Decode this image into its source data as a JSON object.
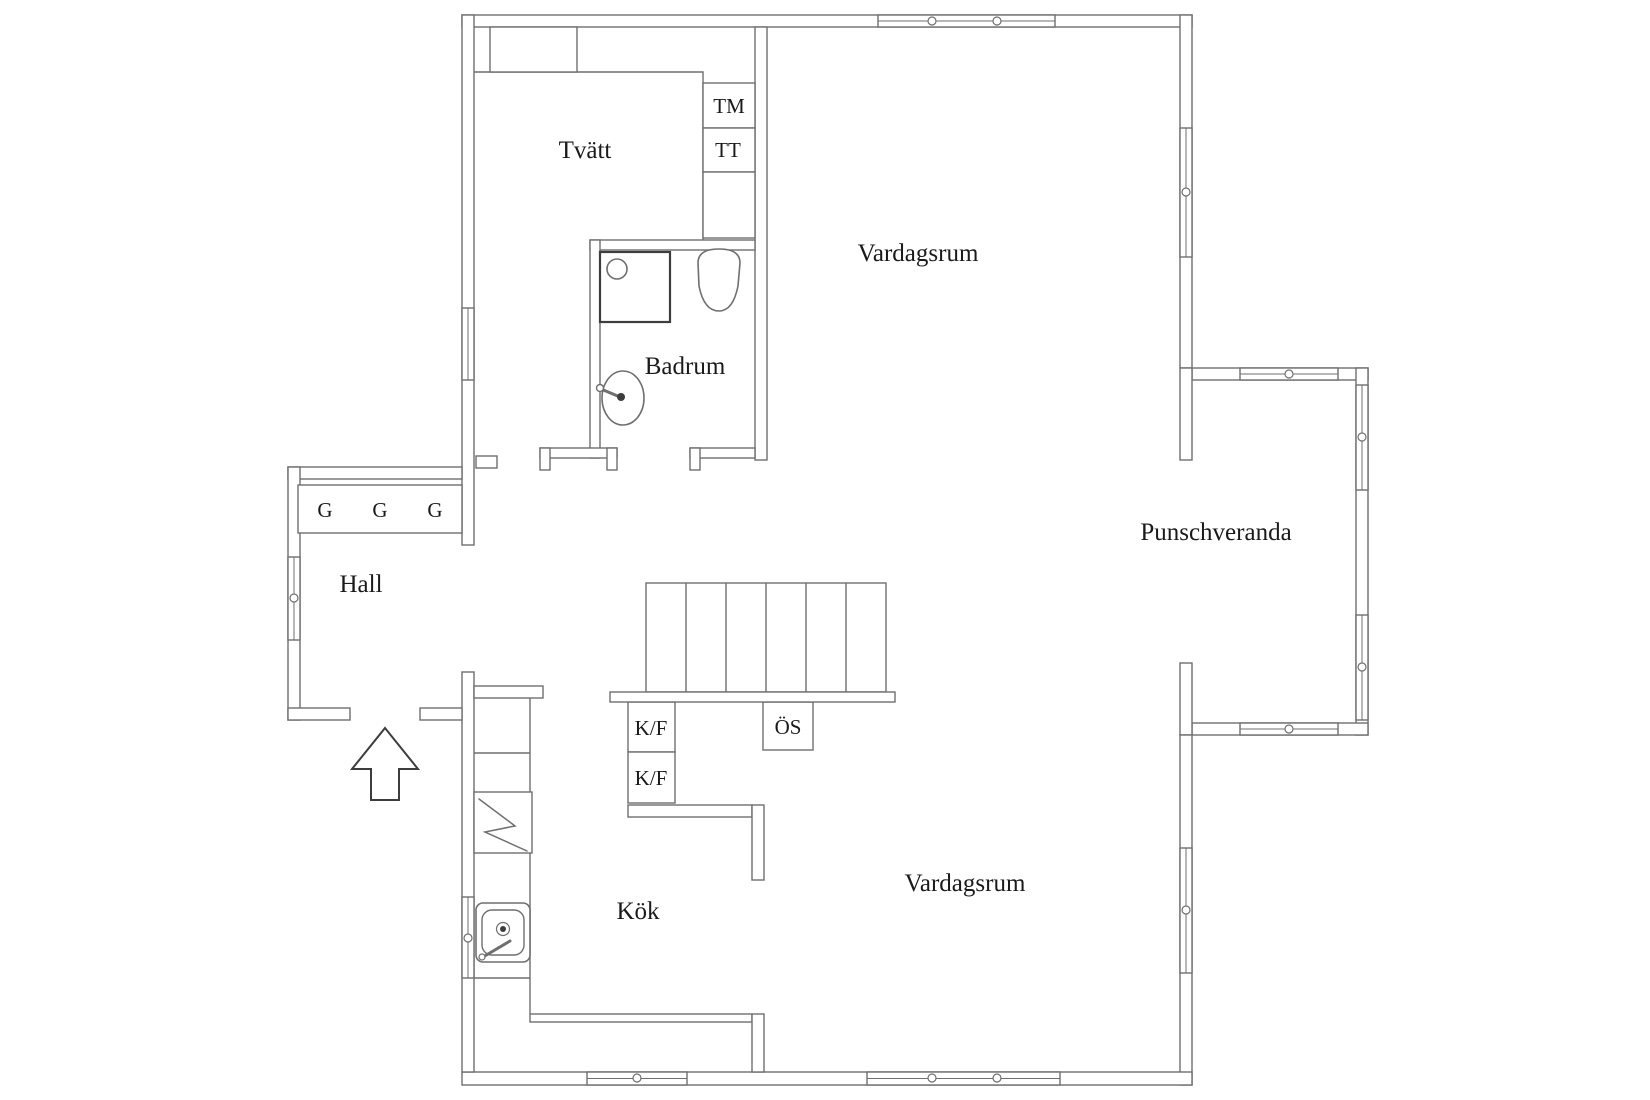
{
  "page": {
    "title": "Floor plan",
    "background": "#ffffff"
  },
  "palette": {
    "wall_line": "#6f6f6f",
    "dark_line": "#3d3d3d",
    "text_color": "#1a1a1a",
    "white": "#ffffff"
  },
  "plan": {
    "canvas": {
      "width": 1650,
      "height": 1100
    },
    "rooms": [
      {
        "id": "tvatt",
        "label": "Tvätt",
        "x": 585,
        "y": 158
      },
      {
        "id": "badrum",
        "label": "Badrum",
        "x": 685,
        "y": 374
      },
      {
        "id": "vardagsrum-upper",
        "label": "Vardagsrum",
        "x": 918,
        "y": 261
      },
      {
        "id": "hall",
        "label": "Hall",
        "x": 361,
        "y": 592
      },
      {
        "id": "kok",
        "label": "Kök",
        "x": 638,
        "y": 919
      },
      {
        "id": "vardagsrum-lower",
        "label": "Vardagsrum",
        "x": 965,
        "y": 891
      },
      {
        "id": "punschveranda",
        "label": "Punschveranda",
        "x": 1216,
        "y": 540
      }
    ],
    "small_labels": [
      {
        "id": "closet-1",
        "label": "G",
        "x": 325,
        "y": 517
      },
      {
        "id": "closet-2",
        "label": "G",
        "x": 380,
        "y": 517
      },
      {
        "id": "closet-3",
        "label": "G",
        "x": 435,
        "y": 517
      },
      {
        "id": "washing-machine",
        "label": "TM",
        "x": 729,
        "y": 113
      },
      {
        "id": "tumble-dryer",
        "label": "TT",
        "x": 728,
        "y": 157
      },
      {
        "id": "fridge-freezer-1",
        "label": "K/F",
        "x": 651,
        "y": 735
      },
      {
        "id": "fridge-freezer-2",
        "label": "K/F",
        "x": 651,
        "y": 785
      },
      {
        "id": "open-fireplace",
        "label": "ÖS",
        "x": 788,
        "y": 734
      }
    ],
    "walls": [
      {
        "name": "top",
        "x": 462,
        "y": 15,
        "w": 730,
        "h": 12
      },
      {
        "name": "right-upper",
        "x": 1180,
        "y": 15,
        "w": 12,
        "h": 353
      },
      {
        "name": "veranda-top",
        "x": 1192,
        "y": 368,
        "w": 176,
        "h": 12
      },
      {
        "name": "veranda-right",
        "x": 1356,
        "y": 368,
        "w": 12,
        "h": 367
      },
      {
        "name": "veranda-bottom",
        "x": 1192,
        "y": 723,
        "w": 176,
        "h": 12
      },
      {
        "name": "right-mid-a",
        "x": 1180,
        "y": 368,
        "w": 12,
        "h": 92
      },
      {
        "name": "right-mid-b",
        "x": 1180,
        "y": 663,
        "w": 12,
        "h": 72
      },
      {
        "name": "right-lower",
        "x": 1180,
        "y": 735,
        "w": 12,
        "h": 350
      },
      {
        "name": "bottom",
        "x": 462,
        "y": 1072,
        "w": 730,
        "h": 13
      },
      {
        "name": "left-upper",
        "x": 462,
        "y": 15,
        "w": 12,
        "h": 530
      },
      {
        "name": "left-lower",
        "x": 462,
        "y": 672,
        "w": 12,
        "h": 400
      },
      {
        "name": "hall-top",
        "x": 288,
        "y": 467,
        "w": 174,
        "h": 12
      },
      {
        "name": "hall-left",
        "x": 288,
        "y": 467,
        "w": 12,
        "h": 253
      },
      {
        "name": "hall-bottom-left",
        "x": 288,
        "y": 708,
        "w": 62,
        "h": 12
      },
      {
        "name": "hall-bottom-right",
        "x": 420,
        "y": 708,
        "w": 42,
        "h": 12
      },
      {
        "name": "interior-main",
        "x": 755,
        "y": 27,
        "w": 12,
        "h": 433
      },
      {
        "name": "badrum-top",
        "x": 590,
        "y": 240,
        "w": 165,
        "h": 10
      },
      {
        "name": "badrum-left",
        "x": 590,
        "y": 240,
        "w": 10,
        "h": 218
      },
      {
        "name": "block-bottom-left",
        "x": 540,
        "y": 448,
        "w": 77,
        "h": 10
      },
      {
        "name": "block-bottom-right",
        "x": 690,
        "y": 448,
        "w": 65,
        "h": 10
      },
      {
        "name": "door-jamb-1",
        "x": 540,
        "y": 448,
        "w": 10,
        "h": 22
      },
      {
        "name": "door-jamb-2",
        "x": 607,
        "y": 448,
        "w": 10,
        "h": 22
      },
      {
        "name": "door-jamb-3",
        "x": 690,
        "y": 448,
        "w": 10,
        "h": 22
      },
      {
        "name": "hall-opening-stub",
        "x": 476,
        "y": 456,
        "w": 21,
        "h": 12
      },
      {
        "name": "kitchen-stub",
        "x": 474,
        "y": 686,
        "w": 69,
        "h": 12
      },
      {
        "name": "kitchen-east-h",
        "x": 628,
        "y": 805,
        "w": 124,
        "h": 12
      },
      {
        "name": "kitchen-east-v",
        "x": 752,
        "y": 805,
        "w": 12,
        "h": 75
      },
      {
        "name": "kitchen-south",
        "x": 530,
        "y": 1014,
        "w": 222,
        "h": 8
      },
      {
        "name": "kitchen-south-v",
        "x": 752,
        "y": 1014,
        "w": 12,
        "h": 58
      }
    ],
    "windows": [
      {
        "name": "top-wall-window",
        "x": 878,
        "y": 15,
        "w": 177,
        "h": 12,
        "circles": [
          [
            932,
            21
          ],
          [
            997,
            21
          ]
        ]
      },
      {
        "name": "upper-right-window",
        "x": 1180,
        "y": 128,
        "w": 12,
        "h": 129,
        "circles": [
          [
            1186,
            192
          ]
        ]
      },
      {
        "name": "veranda-top-window",
        "x": 1240,
        "y": 368,
        "w": 98,
        "h": 12,
        "circles": [
          [
            1289,
            374
          ]
        ]
      },
      {
        "name": "veranda-right-window-1",
        "x": 1356,
        "y": 385,
        "w": 12,
        "h": 105,
        "circles": [
          [
            1362,
            437
          ]
        ]
      },
      {
        "name": "veranda-right-window-2",
        "x": 1356,
        "y": 615,
        "w": 12,
        "h": 105,
        "circles": [
          [
            1362,
            667
          ]
        ]
      },
      {
        "name": "veranda-bottom-window",
        "x": 1240,
        "y": 723,
        "w": 98,
        "h": 12,
        "circles": [
          [
            1289,
            729
          ]
        ]
      },
      {
        "name": "lower-right-window",
        "x": 1180,
        "y": 848,
        "w": 12,
        "h": 125,
        "circles": [
          [
            1186,
            910
          ]
        ]
      },
      {
        "name": "bottom-window-left",
        "x": 587,
        "y": 1072,
        "w": 100,
        "h": 13,
        "circles": [
          [
            637,
            1078
          ]
        ]
      },
      {
        "name": "bottom-window-right",
        "x": 867,
        "y": 1072,
        "w": 193,
        "h": 13,
        "circles": [
          [
            932,
            1078
          ],
          [
            997,
            1078
          ]
        ]
      },
      {
        "name": "left-wall-window",
        "x": 462,
        "y": 308,
        "w": 12,
        "h": 72,
        "circles": []
      },
      {
        "name": "hall-window",
        "x": 288,
        "y": 557,
        "w": 12,
        "h": 83,
        "circles": [
          [
            294,
            598
          ]
        ]
      },
      {
        "name": "kitchen-window",
        "x": 462,
        "y": 897,
        "w": 12,
        "h": 81,
        "circles": [
          [
            468,
            938
          ]
        ]
      }
    ],
    "boxes": [
      {
        "name": "tvatt-cabinets",
        "x": 490,
        "y": 27,
        "w": 87,
        "h": 45
      },
      {
        "name": "hall-closets",
        "x": 298,
        "y": 485,
        "w": 164,
        "h": 48
      },
      {
        "name": "washing-machine-bay",
        "x": 703,
        "y": 83,
        "w": 52,
        "h": 45
      },
      {
        "name": "dryer-bay",
        "x": 703,
        "y": 128,
        "w": 52,
        "h": 44
      },
      {
        "name": "tvatt-empty-bay",
        "x": 703,
        "y": 172,
        "w": 52,
        "h": 66
      },
      {
        "name": "fridge-freezer-box-1",
        "x": 628,
        "y": 702,
        "w": 47,
        "h": 50
      },
      {
        "name": "fridge-freezer-box-2",
        "x": 628,
        "y": 752,
        "w": 47,
        "h": 51
      },
      {
        "name": "fireplace-box",
        "x": 763,
        "y": 702,
        "w": 50,
        "h": 48
      },
      {
        "name": "stove-box",
        "x": 474,
        "y": 792,
        "w": 58,
        "h": 61
      }
    ],
    "lines": [
      {
        "name": "tvatt-counter-edge",
        "pts": "474,72 703,72 703,240"
      },
      {
        "name": "cabinet-divider",
        "pts": "533,27 533,72"
      },
      {
        "name": "closet-divider-1",
        "pts": "353,485 353,533"
      },
      {
        "name": "closet-divider-2",
        "pts": "408,485 408,533"
      },
      {
        "name": "kitchen-counter-edge",
        "pts": "530,698 530,1014"
      },
      {
        "name": "kitchen-counter-divider",
        "pts": "474,753 530,753"
      },
      {
        "name": "kitchen-counter-bottom",
        "pts": "474,978 530,978"
      }
    ],
    "stairs": {
      "x": 646,
      "y": 583,
      "w": 240,
      "h": 109,
      "treads_x": [
        686,
        726,
        766,
        806,
        846
      ],
      "landing": {
        "x": 610,
        "y": 692,
        "w": 285,
        "h": 10
      }
    },
    "fixtures": [
      {
        "name": "shower",
        "shapes": [
          {
            "t": "rect",
            "x": 600,
            "y": 252,
            "w": 70,
            "h": 70,
            "stroke": "dark_line",
            "sw": 2.2
          },
          {
            "t": "circle",
            "cx": 617,
            "cy": 269,
            "r": 10,
            "sw": 1.6
          }
        ]
      },
      {
        "name": "toilet",
        "shapes": [
          {
            "t": "path",
            "d": "M 698 263 Q 698 249 719 249 Q 740 249 740 263 L 738 286 Q 733 311 719 311 Q 704 311 699 286 Z",
            "sw": 1.6
          }
        ]
      },
      {
        "name": "bathroom-sink",
        "shapes": [
          {
            "t": "ellipse",
            "cx": 623,
            "cy": 398,
            "rx": 21,
            "ry": 27,
            "sw": 1.6
          },
          {
            "t": "line",
            "x1": 601,
            "y1": 389,
            "x2": 620,
            "y2": 397,
            "sw": 3
          },
          {
            "t": "circle",
            "cx": 600,
            "cy": 388,
            "r": 3.5,
            "sw": 1.4
          },
          {
            "t": "circle",
            "cx": 621,
            "cy": 397,
            "r": 4,
            "fill": "dark_line",
            "sw": 0
          }
        ]
      },
      {
        "name": "kitchen-sink",
        "shapes": [
          {
            "t": "rect",
            "x": 476,
            "y": 903,
            "w": 54,
            "h": 59,
            "rx": 7,
            "sw": 1.6
          },
          {
            "t": "rect",
            "x": 482,
            "y": 910,
            "w": 42,
            "h": 45,
            "rx": 10,
            "sw": 1.4
          },
          {
            "t": "circle",
            "cx": 503,
            "cy": 929,
            "r": 6.5,
            "sw": 1.2
          },
          {
            "t": "circle",
            "cx": 503,
            "cy": 929,
            "r": 3,
            "fill": "dark_line",
            "sw": 0
          },
          {
            "t": "line",
            "x1": 483,
            "y1": 957,
            "x2": 510,
            "y2": 941,
            "sw": 3
          },
          {
            "t": "circle",
            "cx": 482,
            "cy": 957,
            "r": 3,
            "sw": 1.2
          }
        ]
      },
      {
        "name": "stove",
        "shapes": [
          {
            "t": "polyline",
            "pts": "479,799 515,826 485,832 527,851",
            "sw": 1.5
          }
        ]
      }
    ],
    "entrance_arrow": {
      "points": "385,728 418,769 399,769 399,800 371,800 371,769 352,769"
    }
  }
}
